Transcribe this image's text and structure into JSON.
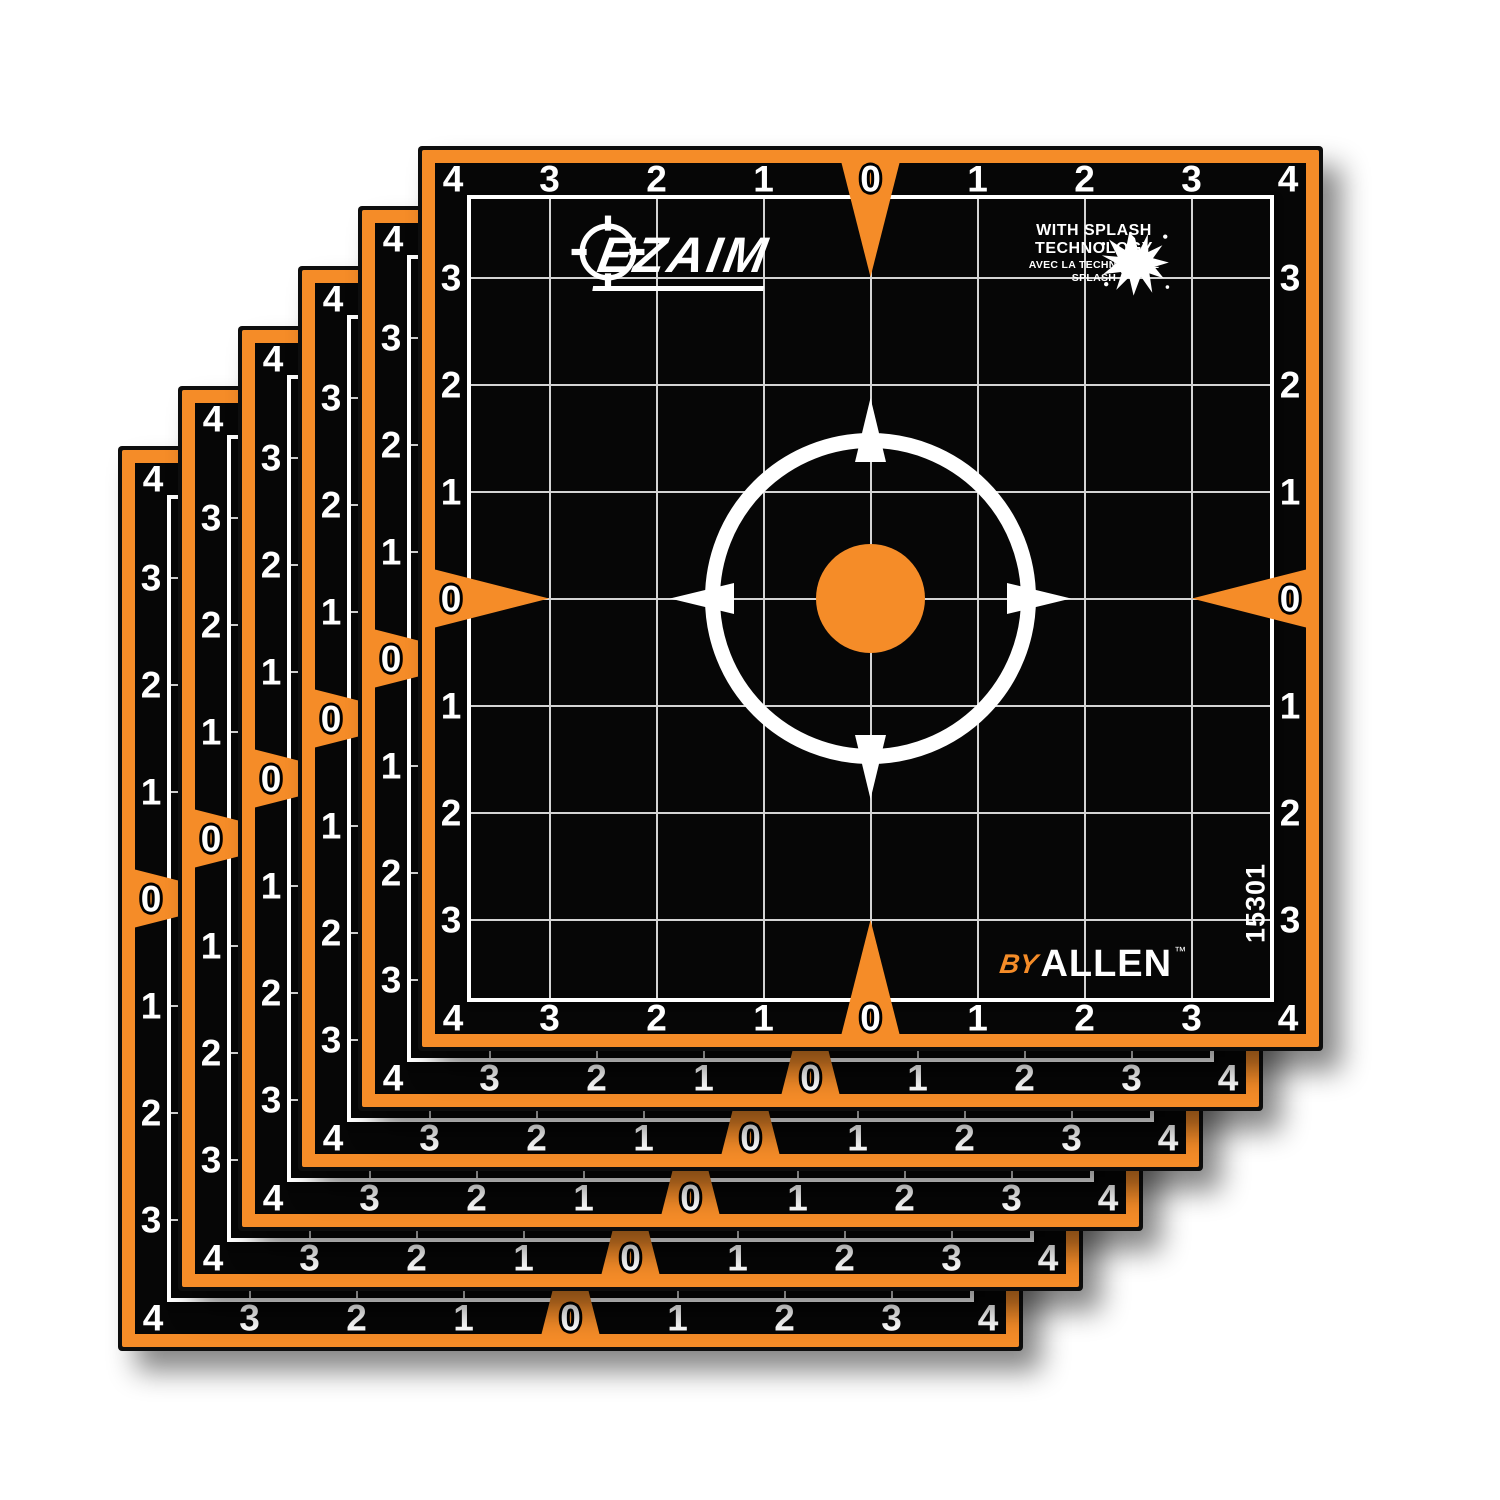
{
  "stack": {
    "count": 6
  },
  "sheet": {
    "edge_labels": [
      "4",
      "3",
      "2",
      "1",
      "0",
      "1",
      "2",
      "3",
      "4"
    ],
    "sku": "15301",
    "logo": {
      "text": "EZAIM"
    },
    "splash": {
      "line1": "WITH SPLASH",
      "line2": "TECHNOLOGY",
      "line3": "AVEC LA TECHNOLOGIE",
      "line4": "SPLASH"
    },
    "byline": {
      "by": "BY",
      "brand": "ALLEN",
      "tm": "™"
    },
    "colors": {
      "orange": "#F58C28",
      "face_black": "#060606",
      "frame_white": "#FFFFFF",
      "grid_line": "#D4D4D4",
      "outline_black": "#0D0D0D"
    }
  }
}
